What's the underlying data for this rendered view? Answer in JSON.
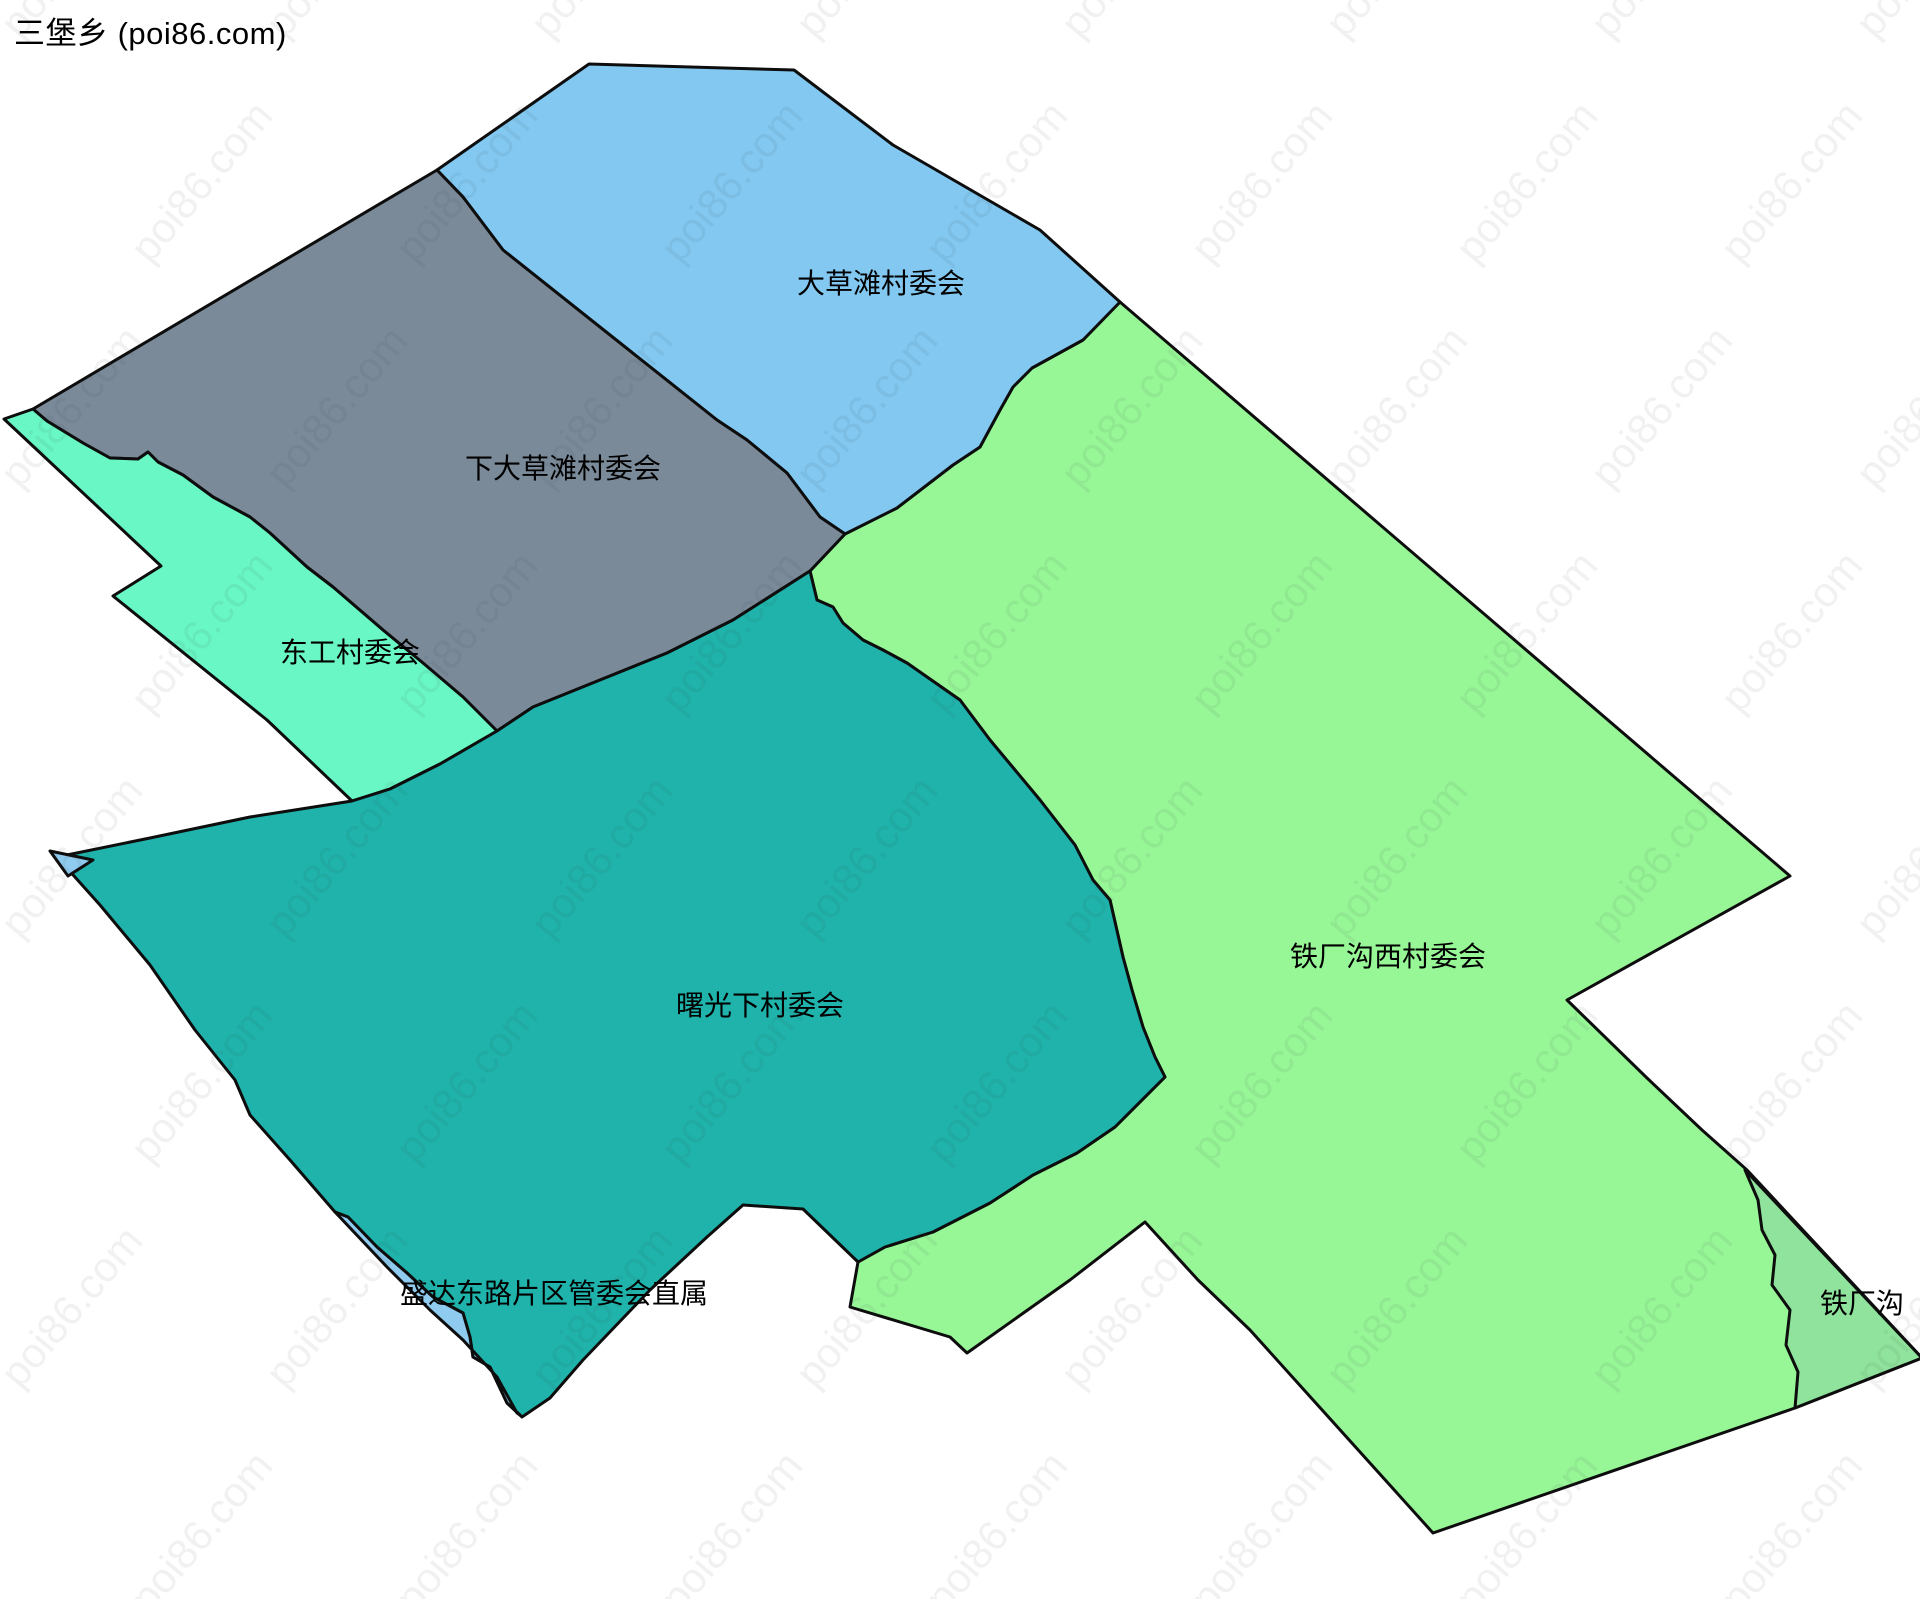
{
  "title": "三堡乡 (poi86.com)",
  "watermark": {
    "text": "poi86.com"
  },
  "map": {
    "background": "#ffffff",
    "stroke_color": "#0d0d0d",
    "stroke_width": 3,
    "regions": [
      {
        "id": "tiechanggouxi",
        "label": "铁厂沟西村委会",
        "fill": "#97f797",
        "label_x": 1388,
        "label_y": 966,
        "points": "1120,302 1790,876 1567,1000 1647,1078 1702,1130 1747,1170 1922,1358 1795,1408 1433,1533 1250,1330 1198,1280 1145,1222 1070,1280 967,1353 950,1337 850,1307 858,1262 885,1247 933,1232 990,1203 1033,1175 1077,1153 1115,1127 1165,1077 1155,1057 1143,1027 1132,990 1123,957 1110,900 1093,880 1075,845 1040,800 990,740 960,700 907,663 883,650 863,640 843,623 833,607 817,600 810,571 845,534 897,508 953,465 980,447 1000,410 1013,387 1032,368 1083,340"
      },
      {
        "id": "dacaotan",
        "label": "大草滩村委会",
        "fill": "#82c8f0",
        "label_x": 881,
        "label_y": 293,
        "points": "589,64 794,70 893,145 1040,230 1120,302 1083,340 1032,368 1013,387 1000,410 980,447 953,465 897,508 845,534 820,517 787,473 747,440 717,420 503,250 463,197 437,170"
      },
      {
        "id": "xiadacaotan",
        "label": "下大草滩村委会",
        "fill": "#7a8a99",
        "label_x": 563,
        "label_y": 478,
        "points": "437,170 33,409 47,421 83,443 110,458 138,459 148,452 158,462 183,475 213,497 250,517 270,533 307,567 333,587 383,630 423,663 463,697 497,731 533,707 600,680 667,653 733,620 810,571 845,534 820,517 787,473 747,440 717,420 503,250 463,197"
      },
      {
        "id": "donggong",
        "label": "东工村委会",
        "fill": "#69f7c5",
        "label_x": 350,
        "label_y": 662,
        "points": "4,419 33,409 47,421 83,443 110,458 138,459 148,452 158,462 183,475 213,497 250,517 270,533 307,567 333,587 383,630 423,663 463,697 497,731 440,764 390,789 352,801 267,720 113,596 161,566"
      },
      {
        "id": "shuguangxia",
        "label": "曙光下村委会",
        "fill": "#1fb3ab",
        "label_x": 760,
        "label_y": 1015,
        "points": "497,731 533,707 600,680 667,653 733,620 810,571 817,600 833,607 843,623 863,640 883,650 907,663 960,700 990,740 1040,800 1075,845 1093,880 1110,900 1123,957 1132,990 1143,1027 1155,1057 1165,1077 1115,1127 1077,1153 1033,1175 990,1203 933,1232 885,1247 858,1262 803,1209 743,1205 707,1237 650,1290 583,1360 550,1398 522,1417 507,1403 490,1367 473,1357 470,1337 463,1313 433,1297 407,1273 377,1247 348,1217 335,1212 290,1160 250,1115 235,1080 195,1030 150,965 100,905 57,857 150,838 250,817 352,801 390,789 440,764"
      },
      {
        "id": "shengdadonglu",
        "label": "盛达东路片区管委会直属",
        "fill": "#8fcbef",
        "label_x": 554,
        "label_y": 1303,
        "points": "335,1212 348,1217 377,1247 407,1273 433,1297 463,1313 470,1337 473,1357 490,1367 507,1403 520,1415 517,1413 497,1377 463,1340 430,1310 387,1267"
      },
      {
        "id": "tiechanggou-east",
        "label": "铁厂沟",
        "fill": "#8fe39c",
        "label_x": 1862,
        "label_y": 1313,
        "points": "1745,1170 1922,1358 1795,1408 1798,1372 1786,1345 1790,1310 1772,1285 1775,1255 1762,1230 1758,1200"
      },
      {
        "id": "tip-sliver",
        "label": "",
        "fill": "#8fcbef",
        "points": "50,851 93,860 68,876"
      }
    ]
  }
}
